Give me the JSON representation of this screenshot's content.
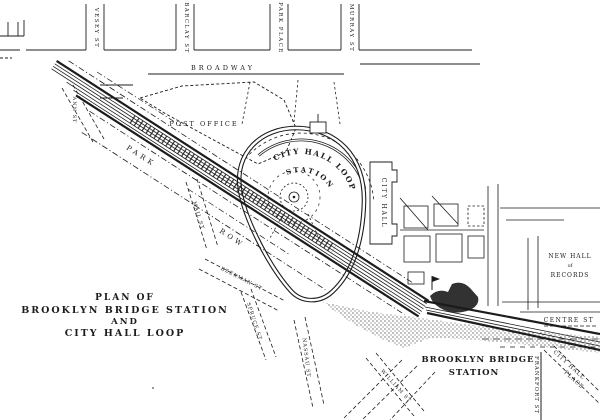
{
  "map": {
    "title": {
      "line1": "PLAN OF",
      "line2": "BROOKLYN BRIDGE STATION",
      "line3": "AND",
      "line4": "CITY HALL LOOP"
    },
    "streets": {
      "broadway": "BROADWAY",
      "vesey": "VESEY ST",
      "barclay": "BARCLAY ST",
      "park_place": "PARK PLACE",
      "murray": "MURRAY ST",
      "park_row_word1": "PARK",
      "park_row_word2": "ROW",
      "ann": "ANN ST",
      "mail": "MAIL ST",
      "beekman": "BEEKMAN ST",
      "spruce": "SPRUCE ST",
      "nassau": "NASSAU ST",
      "william": "WILLIAM ST",
      "frankfort": "FRANKFORT ST",
      "city_hall_place_line1": "CITY HALL",
      "city_hall_place_line2": "PLACE",
      "centre": "CENTRE ST"
    },
    "landmarks": {
      "post_office": "POST OFFICE",
      "city_hall": "CITY HALL",
      "hall_of_records_line1": "NEW HALL",
      "hall_of_records_line2": "of",
      "hall_of_records_line3": "RECORDS"
    },
    "stations": {
      "loop_name": "CITY HALL LOOP",
      "loop_station_word": "STATION",
      "brooklyn_bridge_line1": "BROOKLYN BRIDGE",
      "brooklyn_bridge_line2": "STATION"
    },
    "colors": {
      "ink": "#1c1c1c",
      "paper": "#ffffff"
    }
  }
}
